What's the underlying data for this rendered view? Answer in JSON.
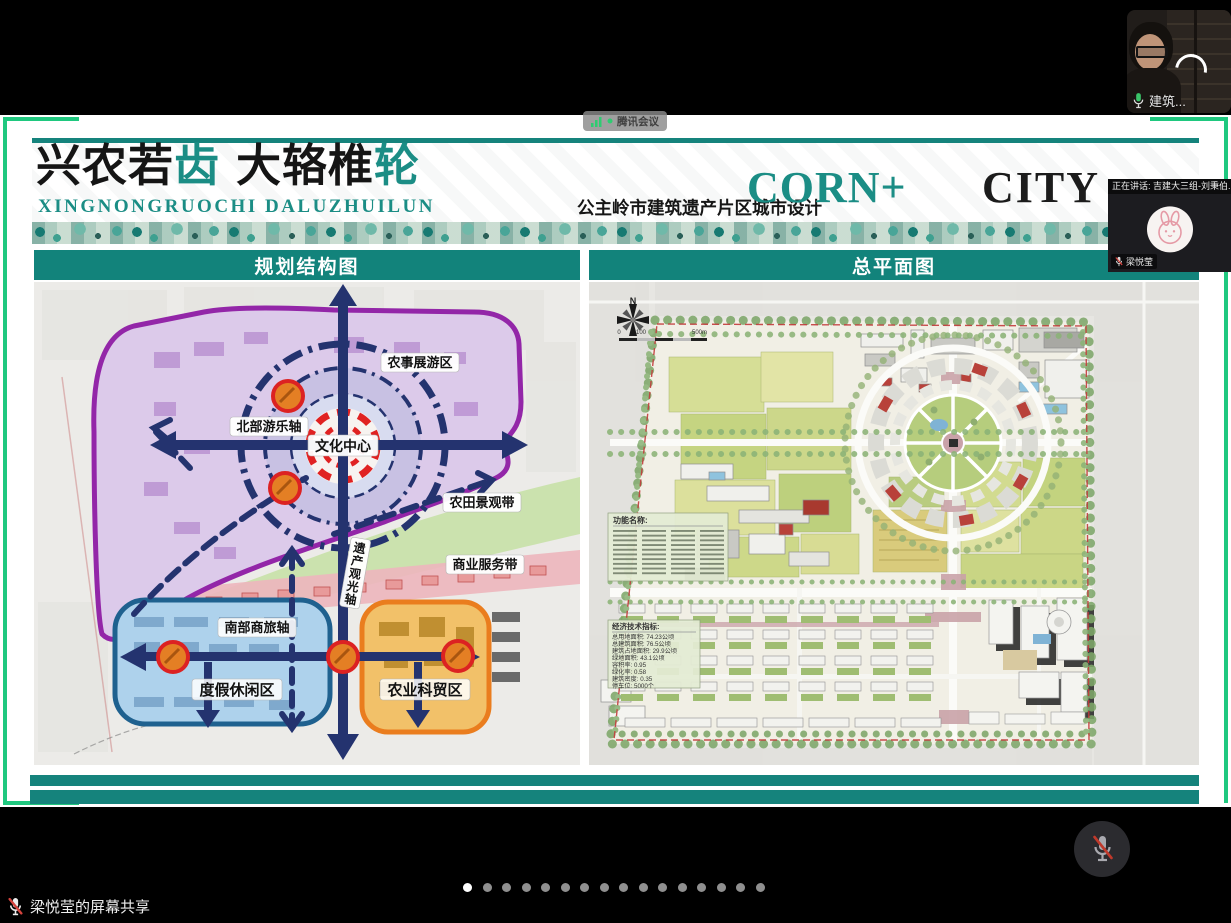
{
  "meeting": {
    "app_badge_label": "腾讯会议",
    "speaker_banner": "正在讲话: 吉建大三组-刘秉伯...",
    "video1_name": "建筑...",
    "avatar_name": "梁悦莹",
    "share_label": "梁悦莹的屏幕共享",
    "pagination": {
      "count": 16,
      "active": 0
    }
  },
  "slide": {
    "header": {
      "title_parts": [
        "兴农若",
        "齿",
        "大辂椎",
        "轮"
      ],
      "pinyin": "XINGNONGRUOCHI DALUZHUILUN",
      "subtitle_cn": "公主岭市建筑遗产片区城市设计",
      "corn": "CORN+",
      "city": "CITY"
    },
    "left_panel": {
      "title": "规划结构图",
      "labels": {
        "zone_top": "农事展游区",
        "axis_north": "北部游乐轴",
        "center": "文化中心",
        "band_farm": "农田景观带",
        "axis_heritage": "遗产观光轴",
        "band_biz": "商业服务带",
        "axis_south": "南部商旅轴",
        "zone_resort": "度假休闲区",
        "zone_agritech": "农业科贸区"
      }
    },
    "right_panel": {
      "title": "总平面图",
      "north_label": "N",
      "scale_labels": [
        "0",
        "100",
        "500m"
      ],
      "legend_function_title": "功能名称:",
      "legend_indicator_title": "经济技术指标:",
      "indicators": [
        "总用地面积: 74.23公顷",
        "总建筑面积: 76.5公顷",
        "建筑占地面积: 29.9公顷",
        "绿地面积: 43.1公顷",
        "容积率: 0.95",
        "绿化率: 0.58",
        "建筑密度: 0.35",
        "停车位: 5000个"
      ]
    }
  },
  "colors": {
    "teal": "#15837c",
    "frame_green": "#1fc87f",
    "navy": "#24336f",
    "accent_red": "#dd2020"
  }
}
